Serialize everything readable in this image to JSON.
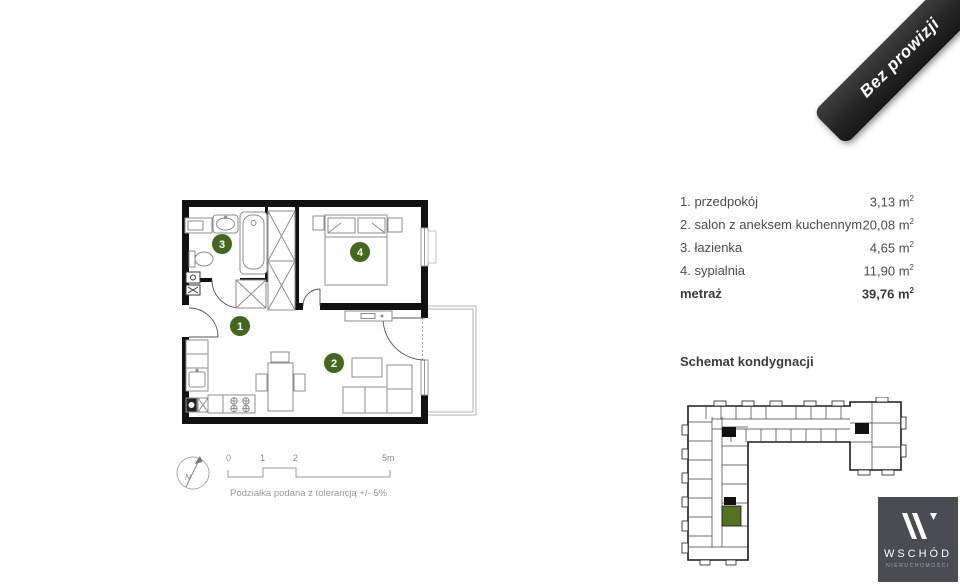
{
  "ribbon": {
    "label": "Bez prowizji",
    "color": "#262626"
  },
  "legend": {
    "rows": [
      {
        "label": "1. przedpokój",
        "area": "3,13"
      },
      {
        "label": "2. salon z aneksem kuchennym",
        "area": "20,08"
      },
      {
        "label": "3. łazienka",
        "area": "4,65"
      },
      {
        "label": "4. sypialnia",
        "area": "11,90"
      }
    ],
    "total": {
      "label": "metraż",
      "area": "39,76"
    },
    "unit": "m",
    "unit_sup": "2"
  },
  "plan": {
    "rooms": [
      {
        "number": "1"
      },
      {
        "number": "2"
      },
      {
        "number": "3"
      },
      {
        "number": "4"
      }
    ],
    "accent_color": "#41691d"
  },
  "scale_bar": {
    "ticks": [
      "0",
      "1",
      "2",
      "5m"
    ],
    "note": "Podziałka podana z tolerancją +/- 5%",
    "north": "N"
  },
  "floor_schematic": {
    "title": "Schemat kondygnacji",
    "highlight_color": "#527420"
  },
  "logo": {
    "name": "WSCHÓD",
    "subtitle": "NIERUCHOMOŚCI",
    "bg_color": "#4b4b54"
  }
}
